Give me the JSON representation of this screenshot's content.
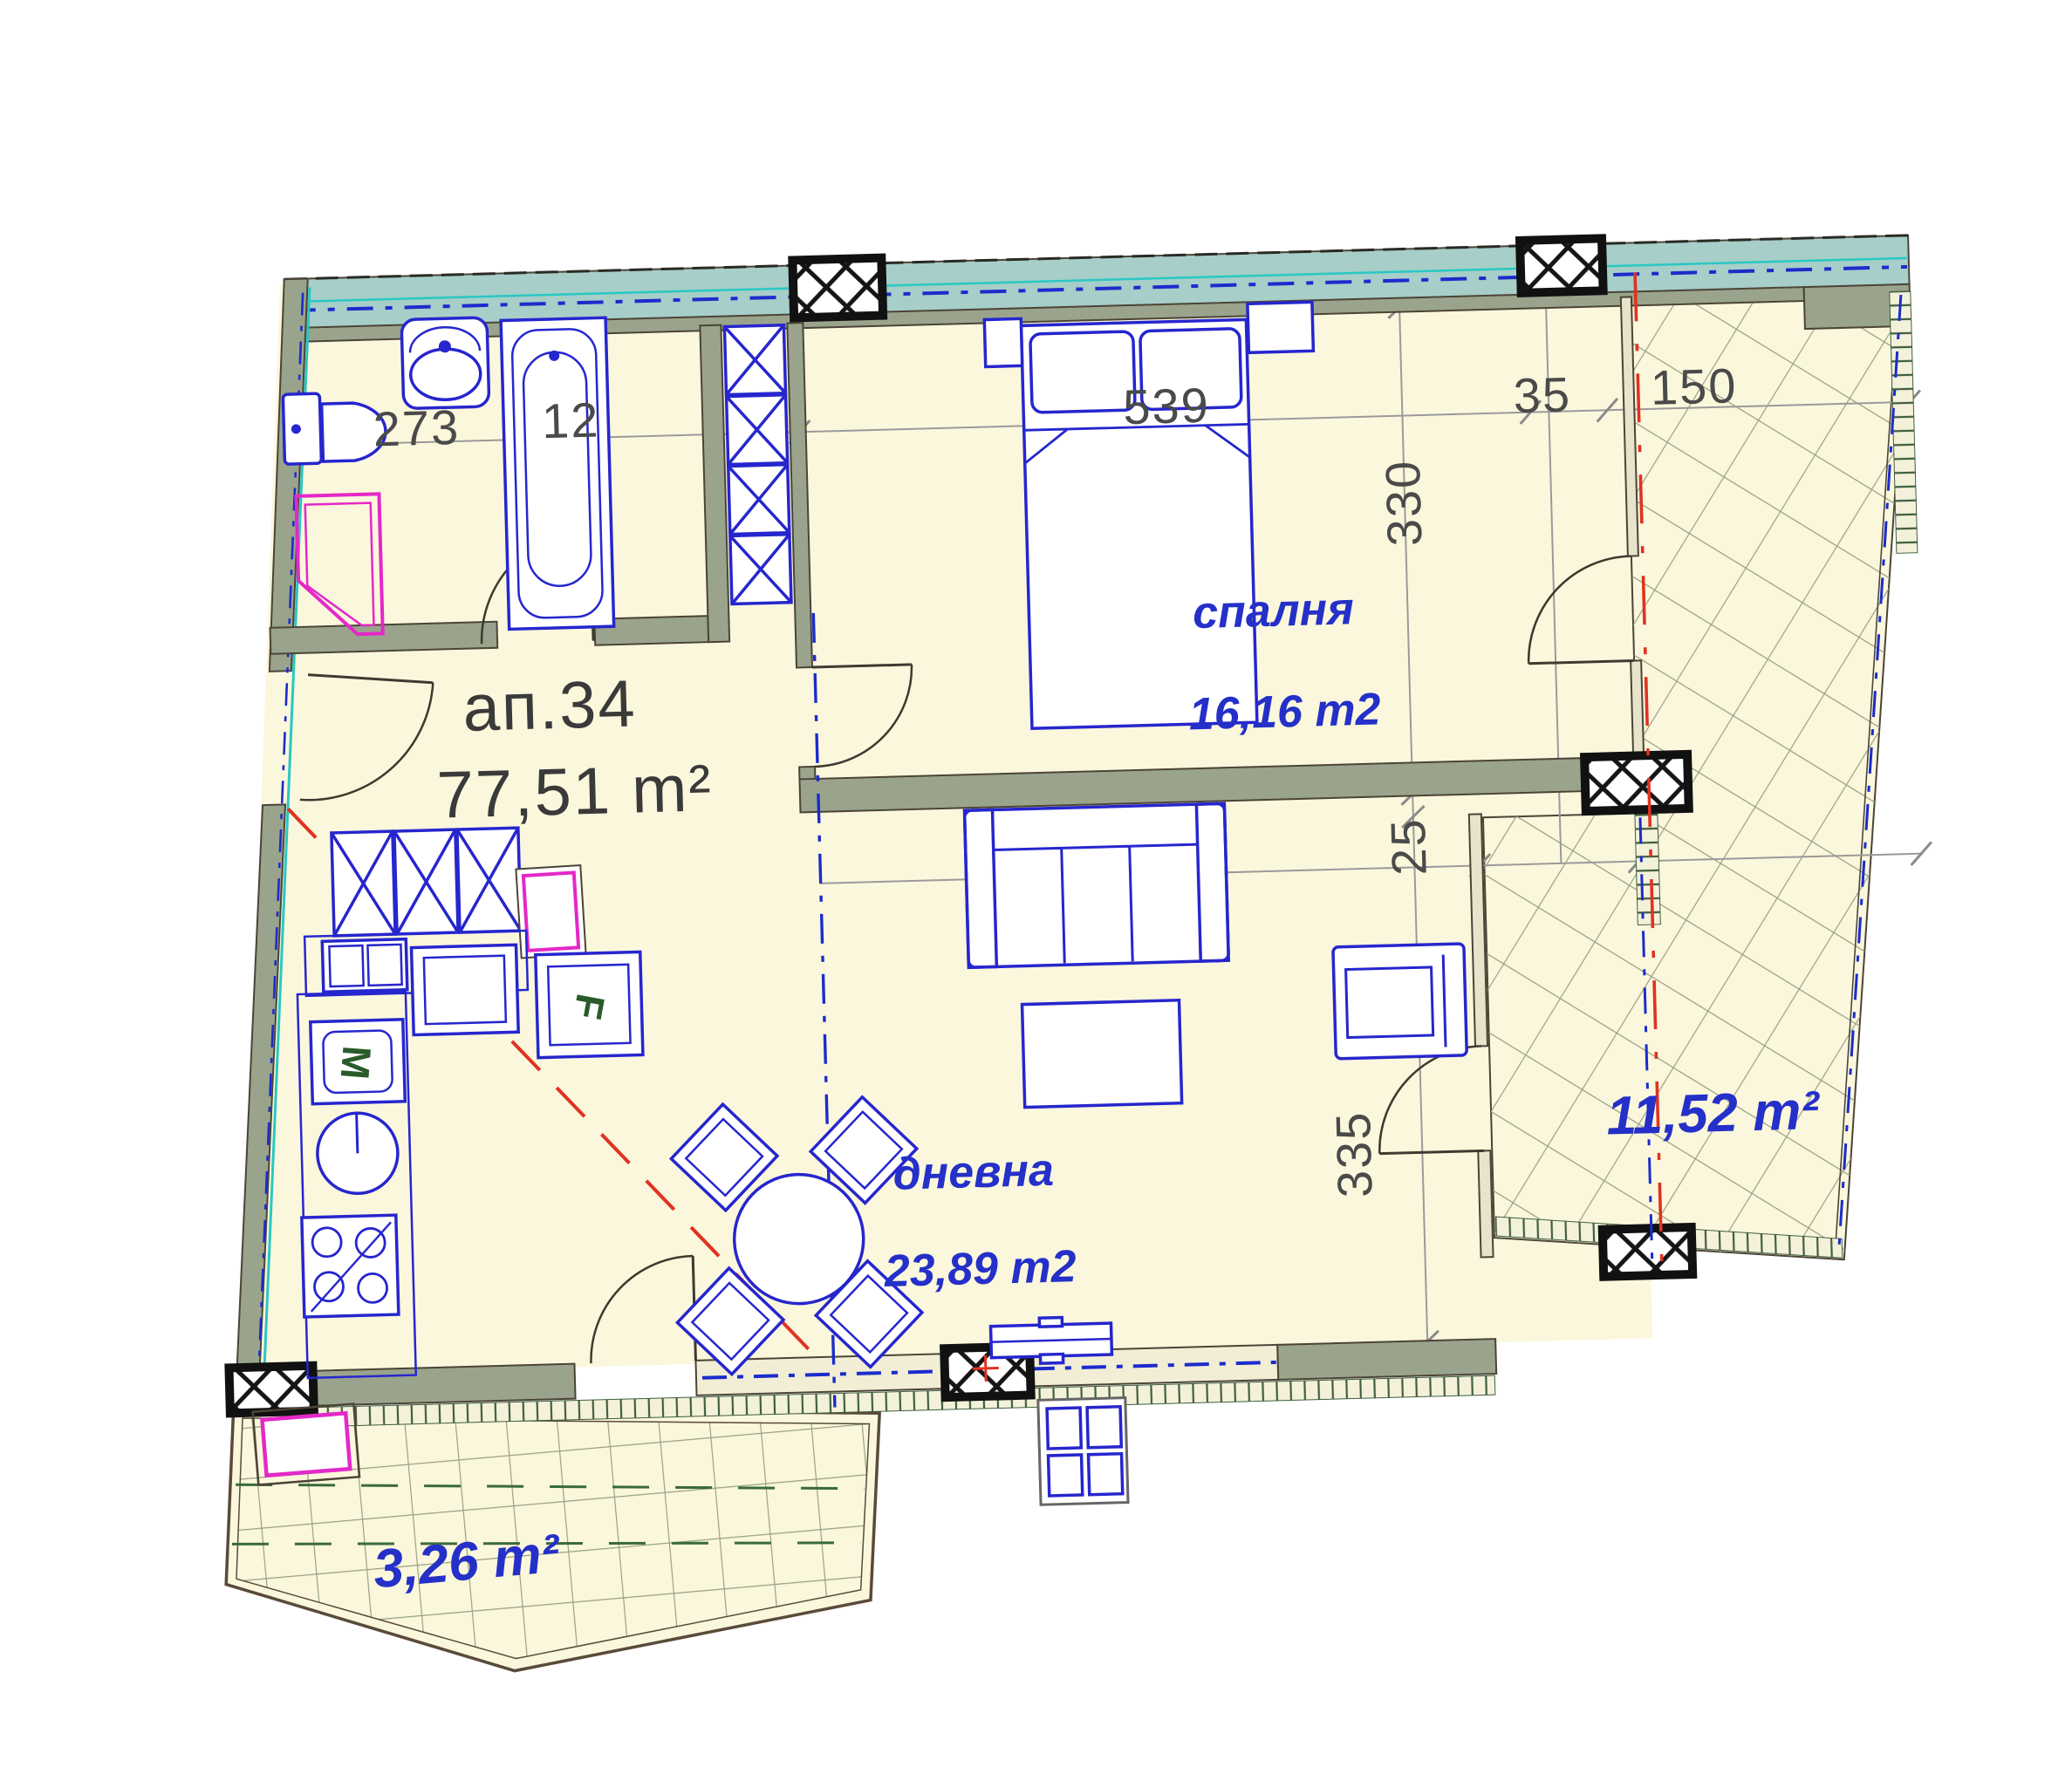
{
  "labels": {
    "apartment": {
      "name": "ап.34",
      "area": "77,51 m²"
    },
    "bedroom": {
      "name": "спалня",
      "area": "16,16 m2"
    },
    "living": {
      "name": "дневна",
      "area": "23,89 m2"
    },
    "terrace": {
      "area": "11,52 m²"
    },
    "balcony": {
      "area": "3,26 m²"
    }
  },
  "dimensions": {
    "toilet_zone": "273",
    "bathtub_zone": "12",
    "bedroom_wall": "539",
    "terrace_gap": "35",
    "terrace_width": "150",
    "bedroom_depth": "330",
    "wall_gap": "25",
    "living_depth": "335"
  },
  "appliances": {
    "fridge": "F",
    "washing_machine": "M"
  },
  "colors": {
    "room_fill": "#FBF7DC",
    "wall_fill": "#9AA48C",
    "wall_edge": "#4B4437",
    "window_band": "#A7CEC8",
    "furniture_blue": "#2626CE",
    "label_blue": "#2430C8",
    "dim_grey": "#4A4A4A",
    "accent_magenta": "#E428C8",
    "axis_red": "#E03222",
    "cyan_line": "#29C8C4",
    "tile_line": "#97A184",
    "appliance_green": "#2A5B2A"
  }
}
